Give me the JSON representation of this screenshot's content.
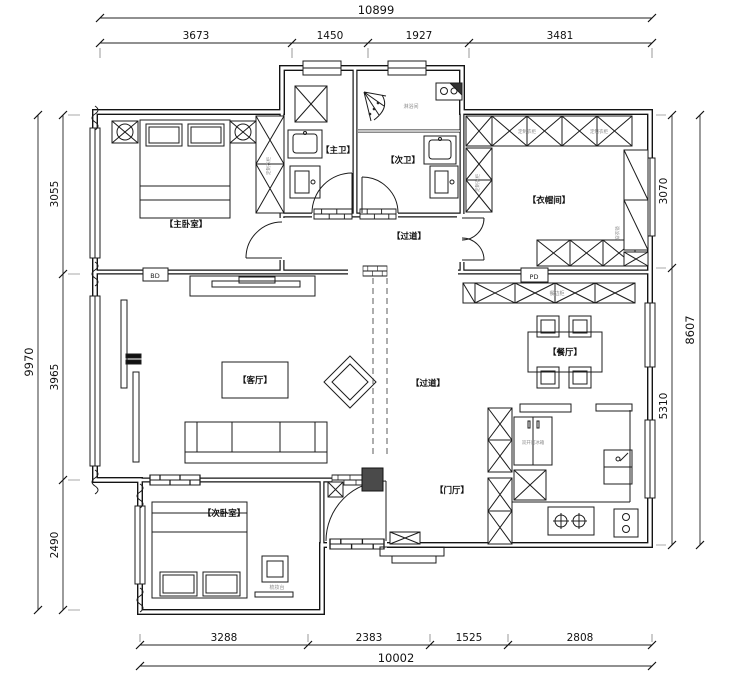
{
  "dims": {
    "top_total": "10899",
    "top_segments": [
      "3673",
      "1450",
      "1927",
      "3481"
    ],
    "bottom_total": "10002",
    "bottom_segments": [
      "3288",
      "2383",
      "1525",
      "2808"
    ],
    "left_total": "9970",
    "left_segments": [
      "3055",
      "3965",
      "2490"
    ],
    "right_total": "8607",
    "right_segments": [
      "3070",
      "5310"
    ]
  },
  "rooms": {
    "master_bedroom": "【主卧室】",
    "master_bath": "【主卫】",
    "second_bath": "【次卫】",
    "cloakroom": "【衣帽间】",
    "corridor_north": "【过道】",
    "living_room": "【客厅】",
    "dining_room": "【餐厅】",
    "corridor_south": "【过道】",
    "foyer": "【门厅】",
    "second_bedroom": "【次卧室】"
  },
  "annotations": {
    "shower_room": "淋浴间",
    "custom_wardrobe_1": "定制衣柜",
    "custom_wardrobe_2": "定制衣柜",
    "custom_wardrobe_3": "定制衣柜",
    "custom_wardrobe_4": "定制衣柜",
    "dressing_mirror": "穿衣镜",
    "sideboard": "餐边柜",
    "fridge": "双开门冰箱",
    "dressing_table": "梳妆台",
    "pipe_duct": "PD",
    "duct": "BD"
  }
}
